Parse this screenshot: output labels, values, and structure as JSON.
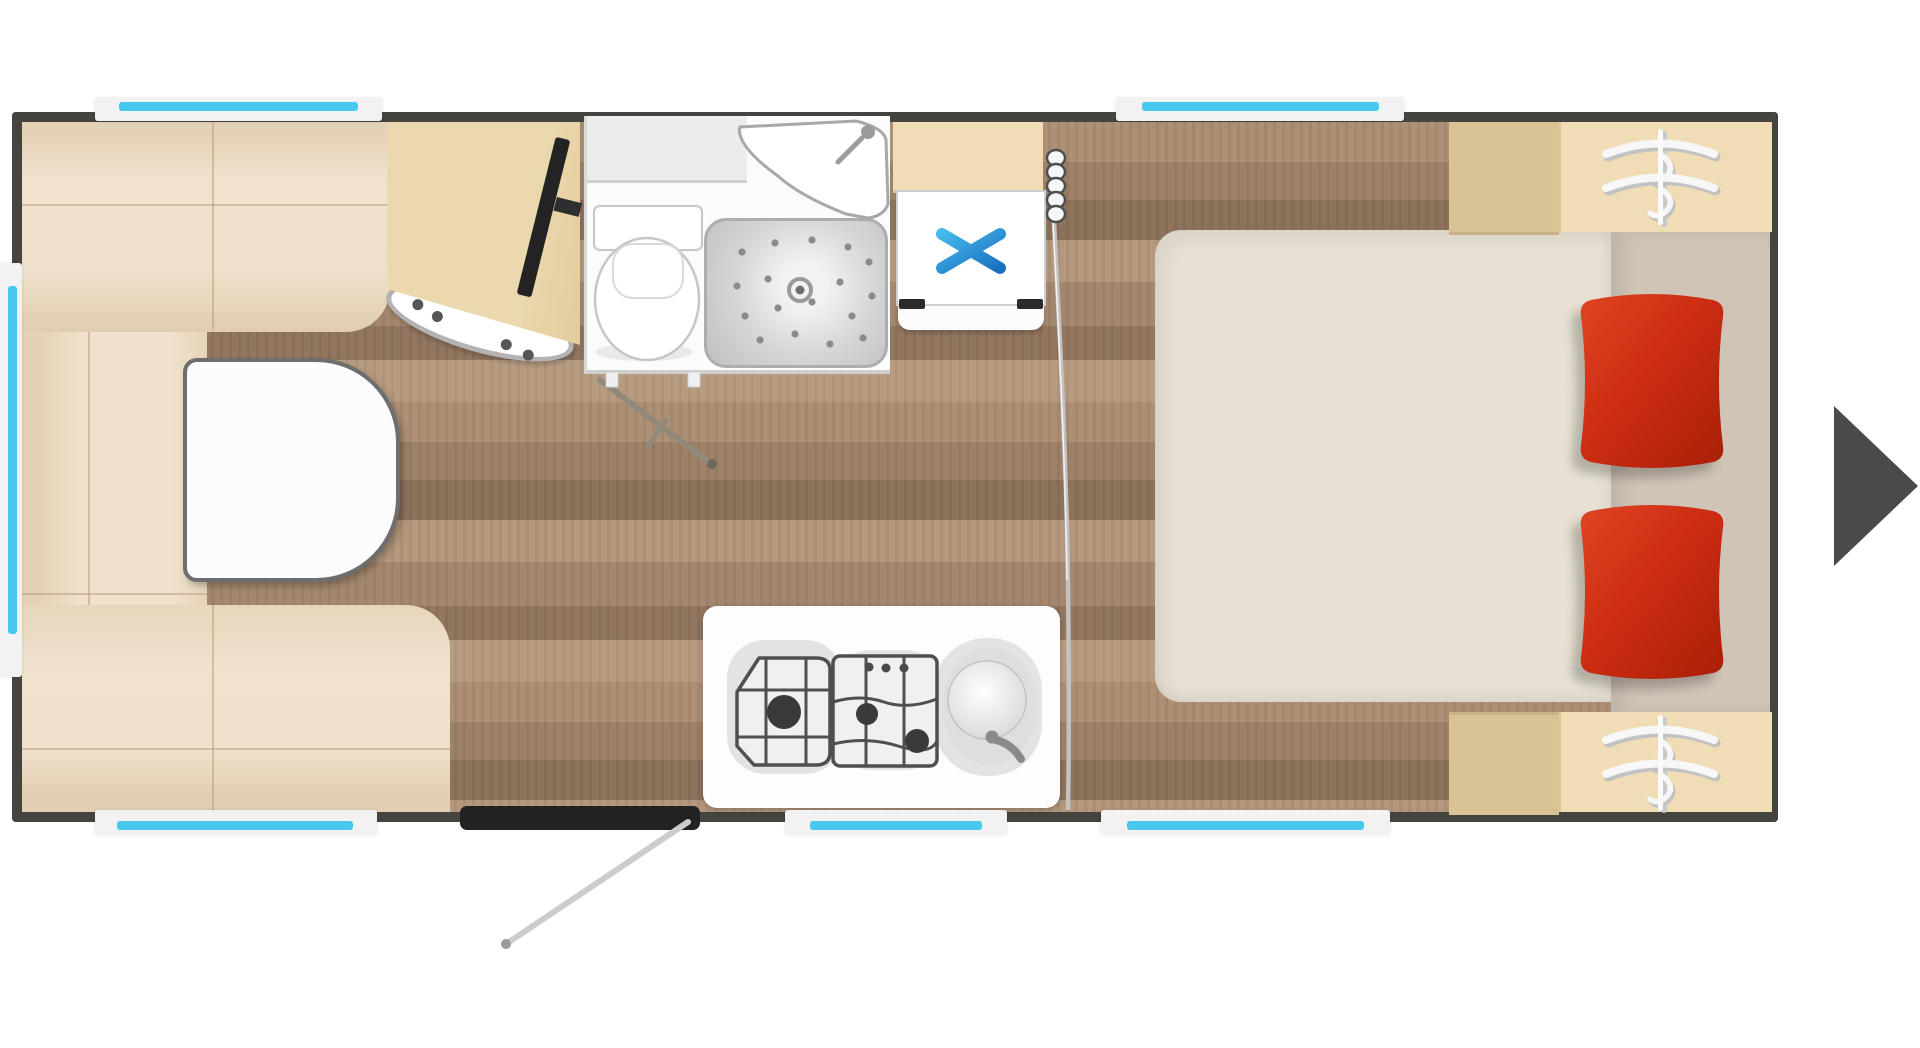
{
  "floorplan": {
    "vehicle": "caravan-floor-plan",
    "rooms": [
      {
        "name": "lounge"
      },
      {
        "name": "washroom"
      },
      {
        "name": "kitchen"
      },
      {
        "name": "bedroom"
      }
    ],
    "furniture": [
      "u-shaped-sofa",
      "pedestal-table",
      "tv",
      "sideboard-shelf",
      "tv-cabinet",
      "toilet",
      "shower-tray",
      "corner-washbasin",
      "fridge-freezer",
      "three-burner-gas-hob",
      "kitchen-sink",
      "island-bed",
      "red-pillow",
      "red-pillow",
      "wardrobe-top",
      "wardrobe-bottom",
      "bedside-cabinet-top",
      "bedside-cabinet-bottom",
      "entry-door",
      "divider-curtain"
    ],
    "window_count": 6,
    "pillow_count": 2
  },
  "icons": {
    "next": "right-arrow",
    "freezer": "snowflake-asterisk",
    "wardrobe": "clothes-hangers",
    "divider": "spring-coil"
  },
  "colors": {
    "wall": "#45443f",
    "windowFrame": "#f2f2f2",
    "windowGlass": "#47c8ec",
    "sofa": "#efe1cb",
    "sofaShade": "#e2cfb2",
    "sofaSeam": "#b99f80",
    "table": "#fcfcfc",
    "tableBorder": "#6e6e6e",
    "deskTan": "#ebd8ae",
    "ovalBorder": "#b3b3b3",
    "bathWhite": "#fbfbfb",
    "bathCounter": "#ececec",
    "showerGray": "#c6c6c6",
    "fixtureLine": "#a8a8a8",
    "fridgeWhite": "#ffffff",
    "freezerBlue": "#2fa8e0",
    "freezerBlueDark": "#1b6fc0",
    "cabinetTan": "#d9c294",
    "wardrobeTan": "#f0ddb5",
    "bedCream": "#e7e1d3",
    "mattressGreige": "#cfc4b6",
    "pillowRed": "#cd2d12",
    "pillowRedDark": "#a81f07",
    "doorDark": "#222222",
    "swingGray": "#cccccc",
    "curtainGray": "#c2c2c2",
    "coilDark": "#4e4e4e",
    "hobLine": "#4f4f4f",
    "burnerDark": "#3a3a3a",
    "recessGray": "#e3e3e3",
    "arrowGray": "#4a4a49",
    "stickGray": "#93897b",
    "floorA": "#b2957a",
    "floorB": "#a0836a",
    "floorC": "#8b6f59"
  }
}
